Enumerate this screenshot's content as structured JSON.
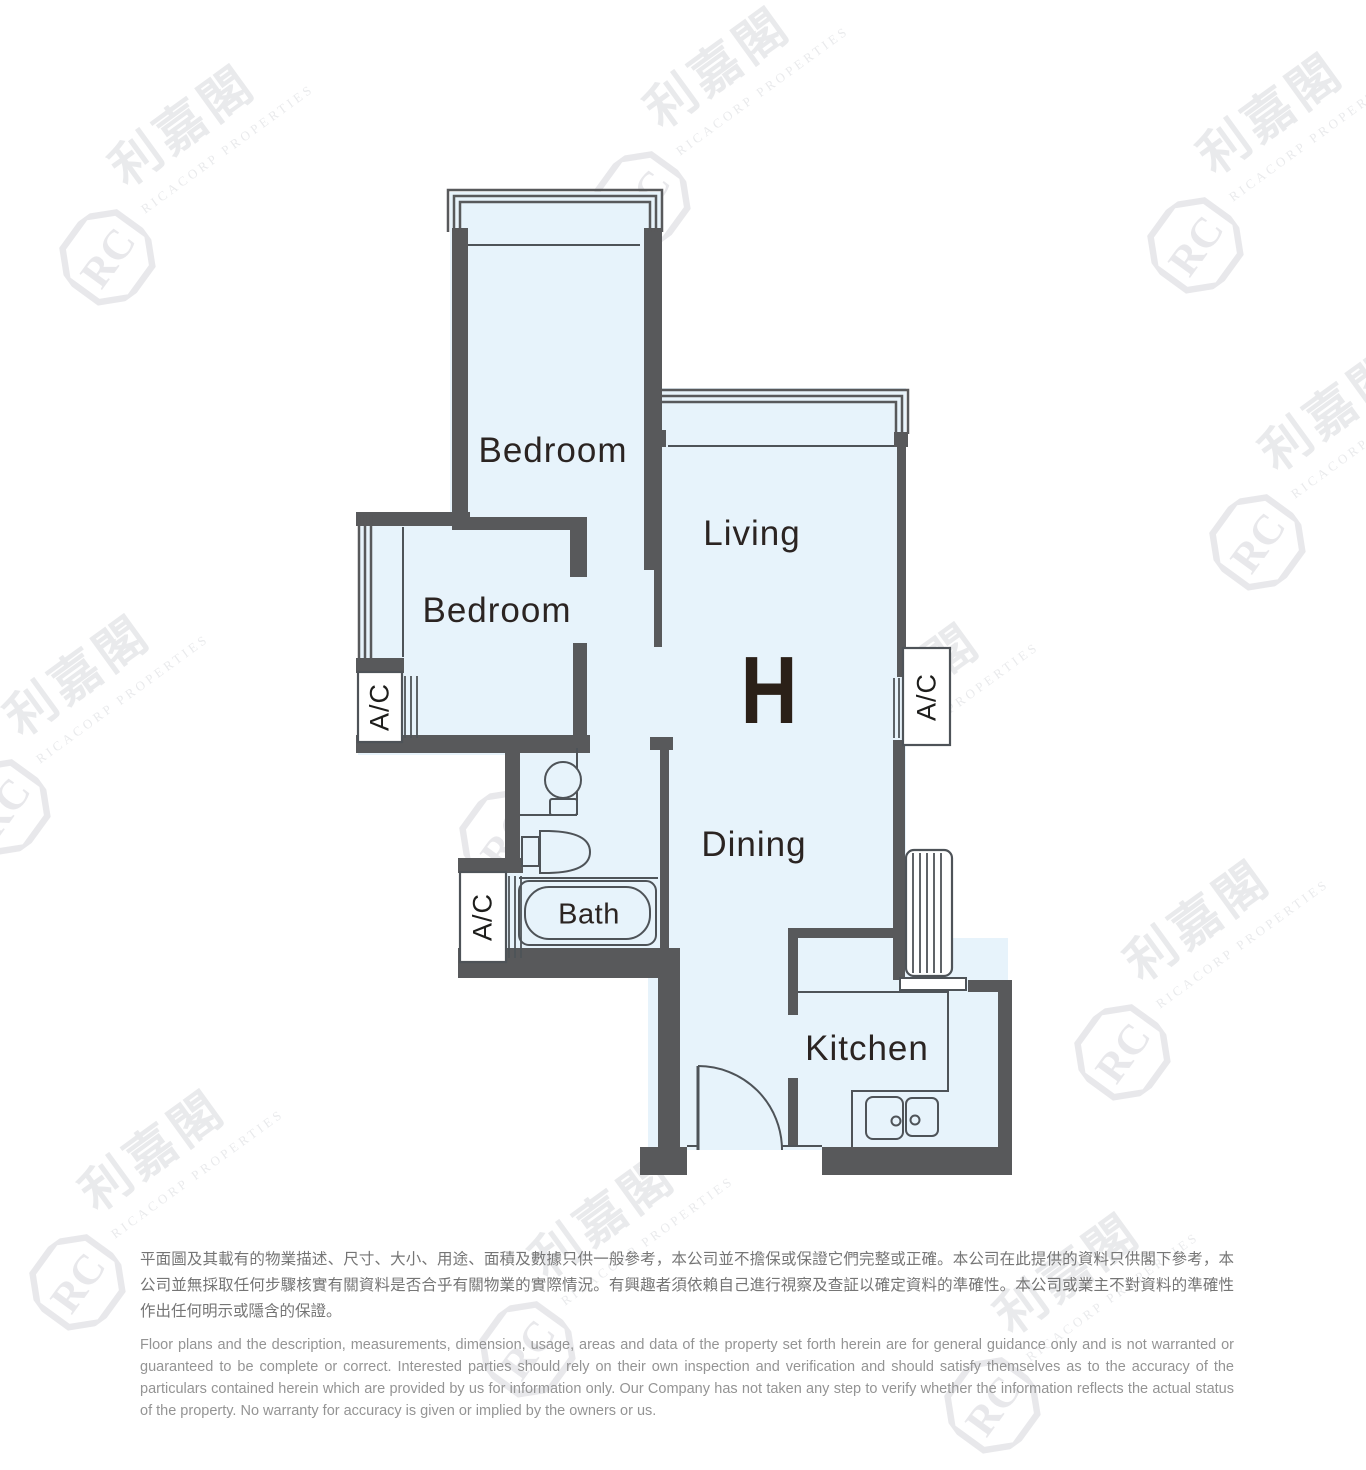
{
  "canvas": {
    "width": 1366,
    "height": 1366,
    "background": "#ffffff"
  },
  "watermark": {
    "cjk": "利嘉閣",
    "latin": "RICACORP PROPERTIES",
    "monogram": "RC"
  },
  "floor_plan": {
    "unit_label": "H",
    "labels": {
      "bedroom_top": "Bedroom",
      "bedroom_mid": "Bedroom",
      "living": "Living",
      "dining": "Dining",
      "kitchen": "Kitchen",
      "bath": "Bath",
      "ac": "A/C"
    },
    "fixtures": [
      "bay-window",
      "louvre-window",
      "ac-platform",
      "toilet",
      "wash-basin",
      "bathtub",
      "kitchen-counter",
      "double-sink",
      "drying-rack",
      "entrance-door-swing"
    ],
    "colors": {
      "wall": "#58595b",
      "floor": "#e7f3fb",
      "fixture_line": "#4e5358",
      "label_text": "#2b2422"
    }
  },
  "disclaimer": {
    "zh": "平面圖及其載有的物業描述、尺寸、大小、用途、面積及數據只供一般參考，本公司並不擔保或保證它們完整或正確。本公司在此提供的資料只供閣下參考，本公司並無採取任何步驟核實有關資料是否合乎有關物業的實際情況。有興趣者須依賴自己進行視察及查証以確定資料的準確性。本公司或業主不對資料的準確性作出任何明示或隱含的保證。",
    "en": "Floor plans and the description, measurements, dimension, usage, areas and data of the property set forth herein are for general guidance only and is not warranted or guaranteed to be complete or correct.  Interested parties should rely on their own inspection and verification and should satisfy themselves as to the accuracy of the particulars contained herein which are provided by us for information only.  Our Company has not taken any step to verify whether the information reflects the actual status of the property.  No warranty for accuracy is given or implied by the owners or us."
  }
}
